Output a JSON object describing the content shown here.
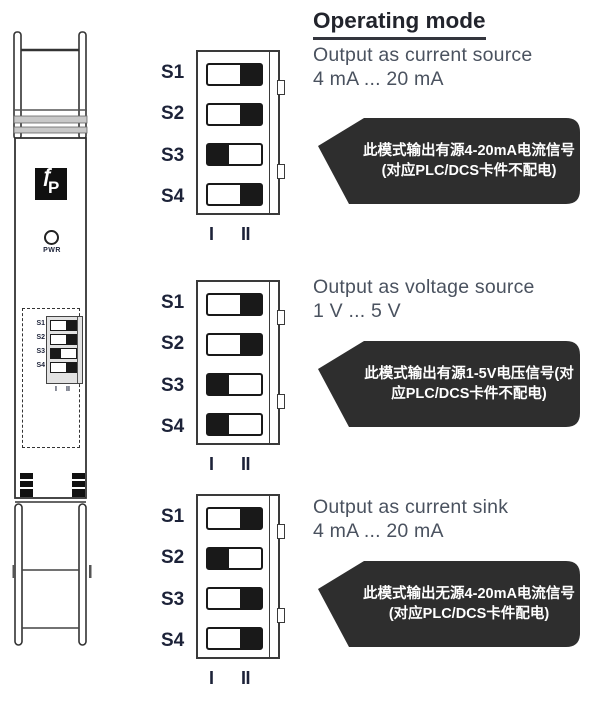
{
  "heading": "Operating mode",
  "position_markers": [
    "I",
    "II"
  ],
  "device": {
    "logo_glyph1": "ƒ",
    "logo_glyph2": "P",
    "pwr_label": "PWR",
    "dip": {
      "labels": [
        "S1",
        "S2",
        "S3",
        "S4"
      ],
      "positions": [
        "II",
        "II",
        "I",
        "II"
      ],
      "markers": [
        "I",
        "II"
      ]
    }
  },
  "modes": [
    {
      "title_line1": "Output as current source",
      "title_line2": "4 mA ... 20 mA",
      "dip": {
        "labels": [
          "S1",
          "S2",
          "S3",
          "S4"
        ],
        "positions": [
          "II",
          "II",
          "I",
          "II"
        ]
      },
      "callout": "此模式输出有源4-20mA电流信号(对应PLC/DCS卡件不配电)"
    },
    {
      "title_line1": "Output as voltage source",
      "title_line2": "1 V ... 5 V",
      "dip": {
        "labels": [
          "S1",
          "S2",
          "S3",
          "S4"
        ],
        "positions": [
          "II",
          "II",
          "I",
          "I"
        ]
      },
      "callout": "此模式输出有源1-5V电压信号(对应PLC/DCS卡件不配电)"
    },
    {
      "title_line1": "Output as current sink",
      "title_line2": "4 mA ... 20 mA",
      "dip": {
        "labels": [
          "S1",
          "S2",
          "S3",
          "S4"
        ],
        "positions": [
          "II",
          "I",
          "II",
          "II"
        ]
      },
      "callout": "此模式输出无源4-20mA电流信号(对应PLC/DCS卡件配电)"
    }
  ],
  "colors": {
    "callout_bg": "#2e2e2e",
    "callout_text": "#ffffff",
    "switch_knob": "#191919",
    "label_navy": "#1c2238",
    "title_gray": "#4a525f",
    "heading_dark": "#22242c",
    "outline": "#3a3a3a"
  }
}
